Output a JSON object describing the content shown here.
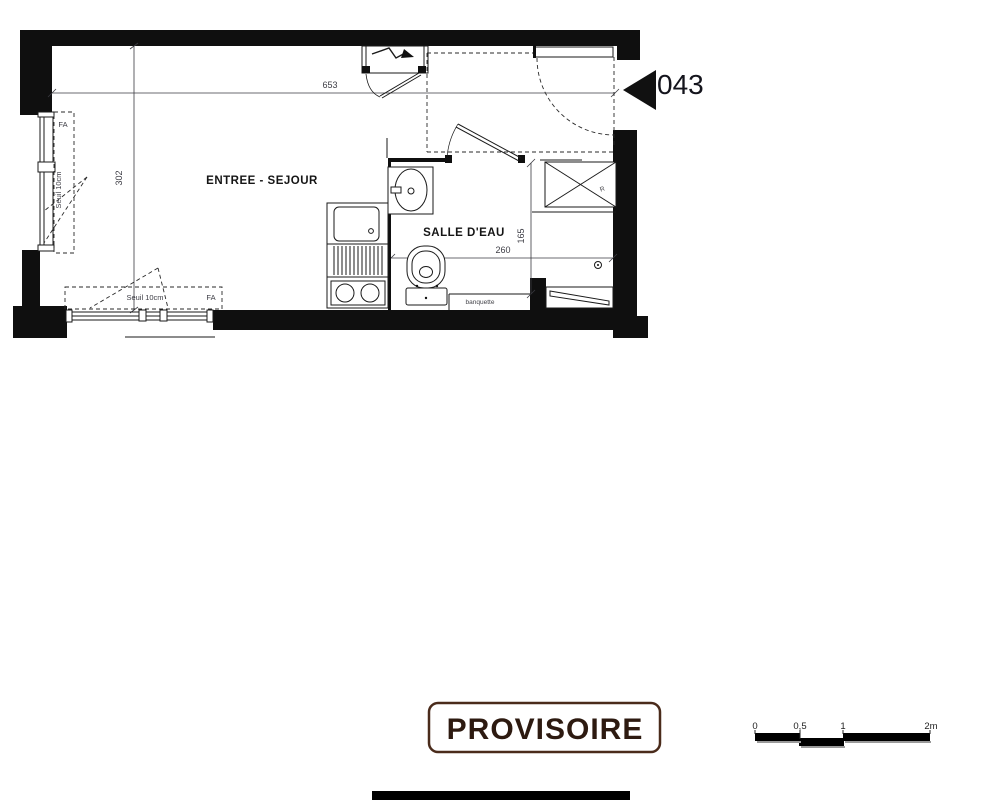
{
  "plan": {
    "unit_number": "043",
    "room_living": "ENTREE - SEJOUR",
    "room_bathroom": "SALLE D'EAU",
    "dim_total_width": "653",
    "dim_total_height": "302",
    "dim_bath_width": "260",
    "dim_bath_depth": "165",
    "window_left_type": "FA",
    "window_left_sill": "Seuil 10cm",
    "window_bottom_type": "FA",
    "window_bottom_sill": "Seuil 10cm",
    "bench_label": "banquette",
    "duct_label": "R"
  },
  "stamp": {
    "text": "PROVISOIRE",
    "border_color": "#4a2b1b",
    "text_color": "#2d1a10"
  },
  "scale_bar": {
    "labels": [
      "0",
      "0,5",
      "1",
      "2m"
    ]
  },
  "colors": {
    "line": "#111111",
    "unit_text": "#14141c"
  }
}
